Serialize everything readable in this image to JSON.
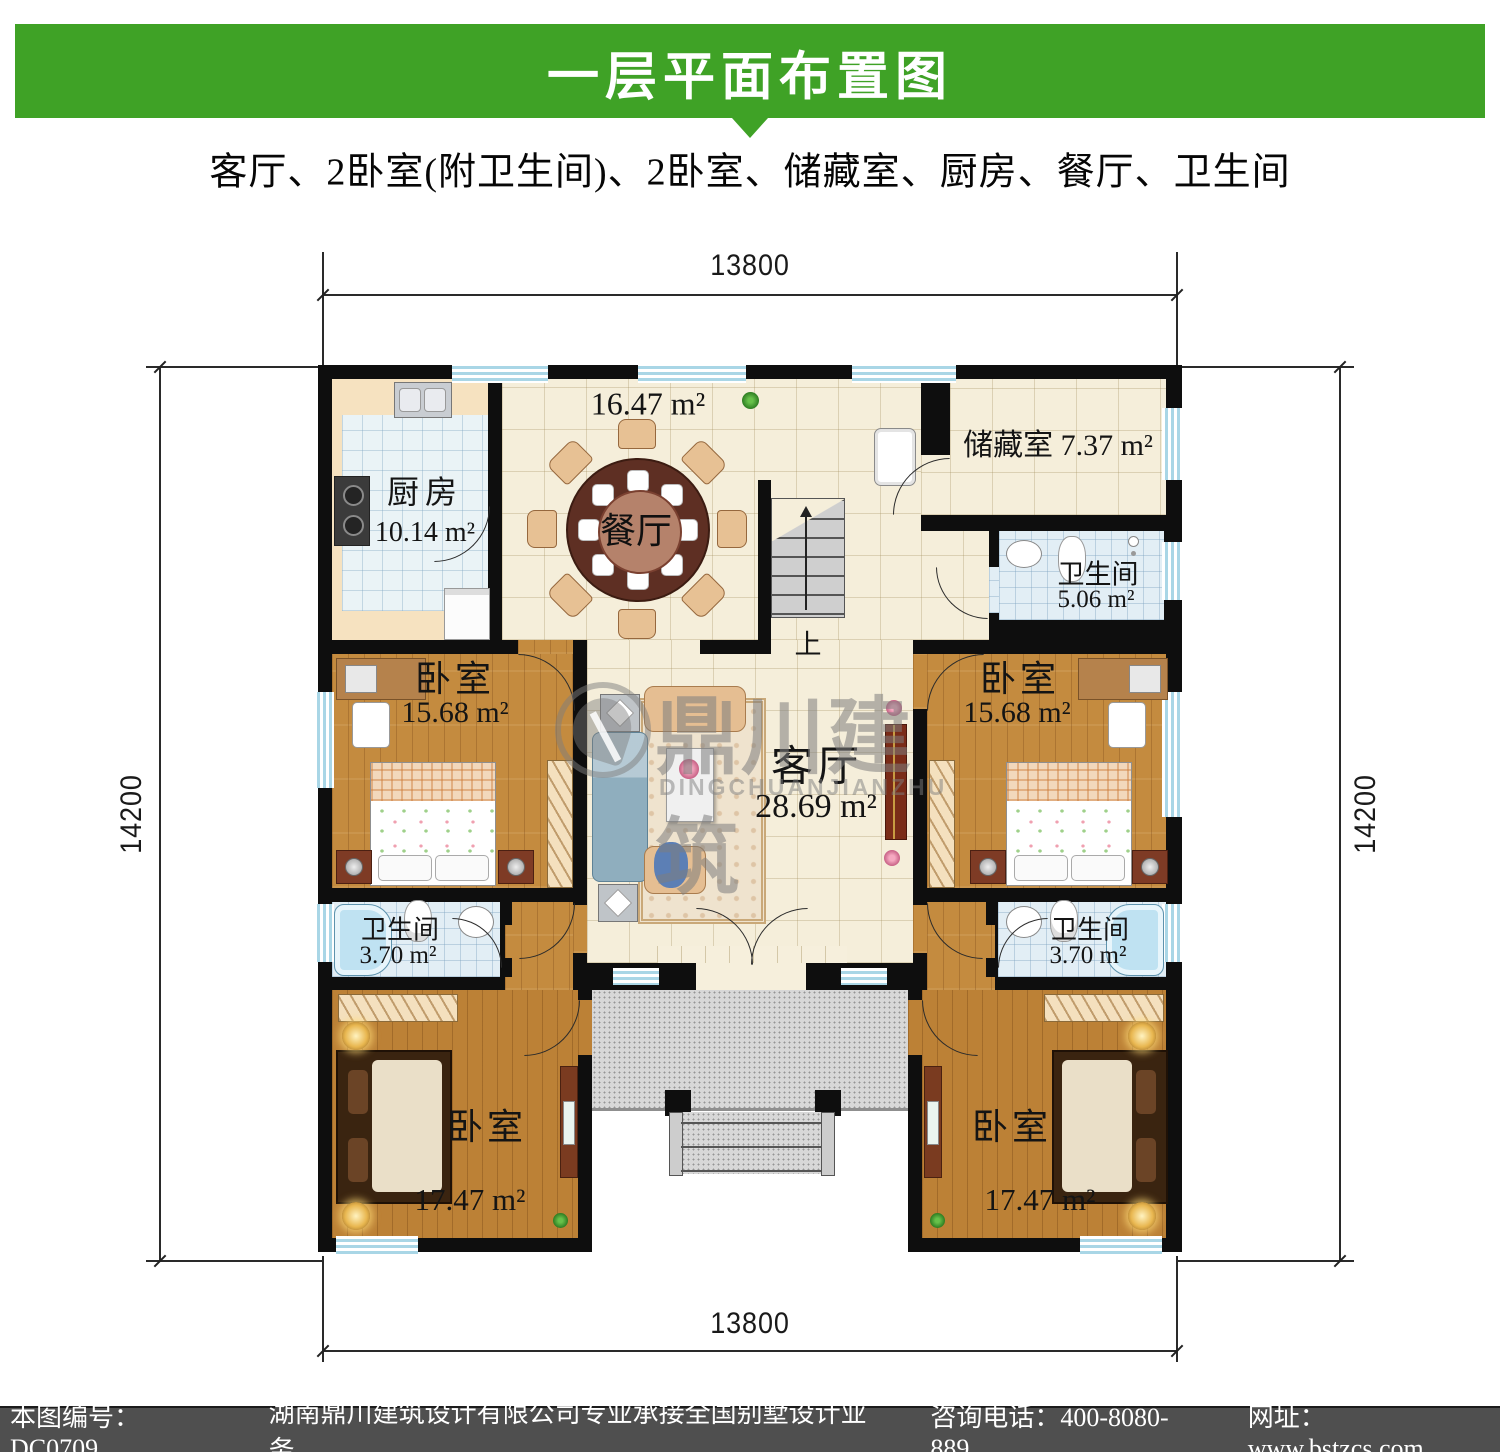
{
  "header": {
    "title": "一层平面布置图",
    "subtitle": "客厅、2卧室(附卫生间)、2卧室、储藏室、厨房、餐厅、卫生间"
  },
  "dimensions": {
    "width_top": "13800",
    "width_bottom": "13800",
    "height_left": "14200",
    "height_right": "14200"
  },
  "rooms": {
    "kitchen": {
      "name": "厨房",
      "area": "10.14 m²"
    },
    "dining": {
      "name": "餐厅",
      "area": "16.47 m²"
    },
    "storage": {
      "name": "储藏室",
      "area": "7.37 m²"
    },
    "bath_top": {
      "name": "卫生间",
      "area": "5.06 m²"
    },
    "bedroom_mid": {
      "name": "卧室",
      "area": "15.68 m²"
    },
    "living": {
      "name": "客厅",
      "area": "28.69 m²"
    },
    "bath_small": {
      "name": "卫生间",
      "area": "3.70 m²"
    },
    "bedroom_bottom": {
      "name": "卧室",
      "area": "17.47 m²"
    },
    "stairs": {
      "up_label": "上"
    }
  },
  "watermark": {
    "title": "鼎川建筑",
    "subtitle": "DINGCHUANJIANZHU"
  },
  "footer": {
    "drawing_no": "本图编号：DC0709",
    "company": "湖南鼎川建筑设计有限公司专业承接全国别墅设计业务",
    "phone": "咨询电话：400-8080-889",
    "website": "网址：www.bstzcs.com"
  },
  "colors": {
    "banner_green": "#3FA226",
    "wall_black": "#0e0e0e",
    "window_blue": "#A9D6E6",
    "tile_beige": "#F5EEDA",
    "bath_tile": "#E2EEF5",
    "wood_floor": "#C48B3F",
    "porch_gray": "#D8D8D8",
    "footer_gray": "#4F4F4F"
  }
}
